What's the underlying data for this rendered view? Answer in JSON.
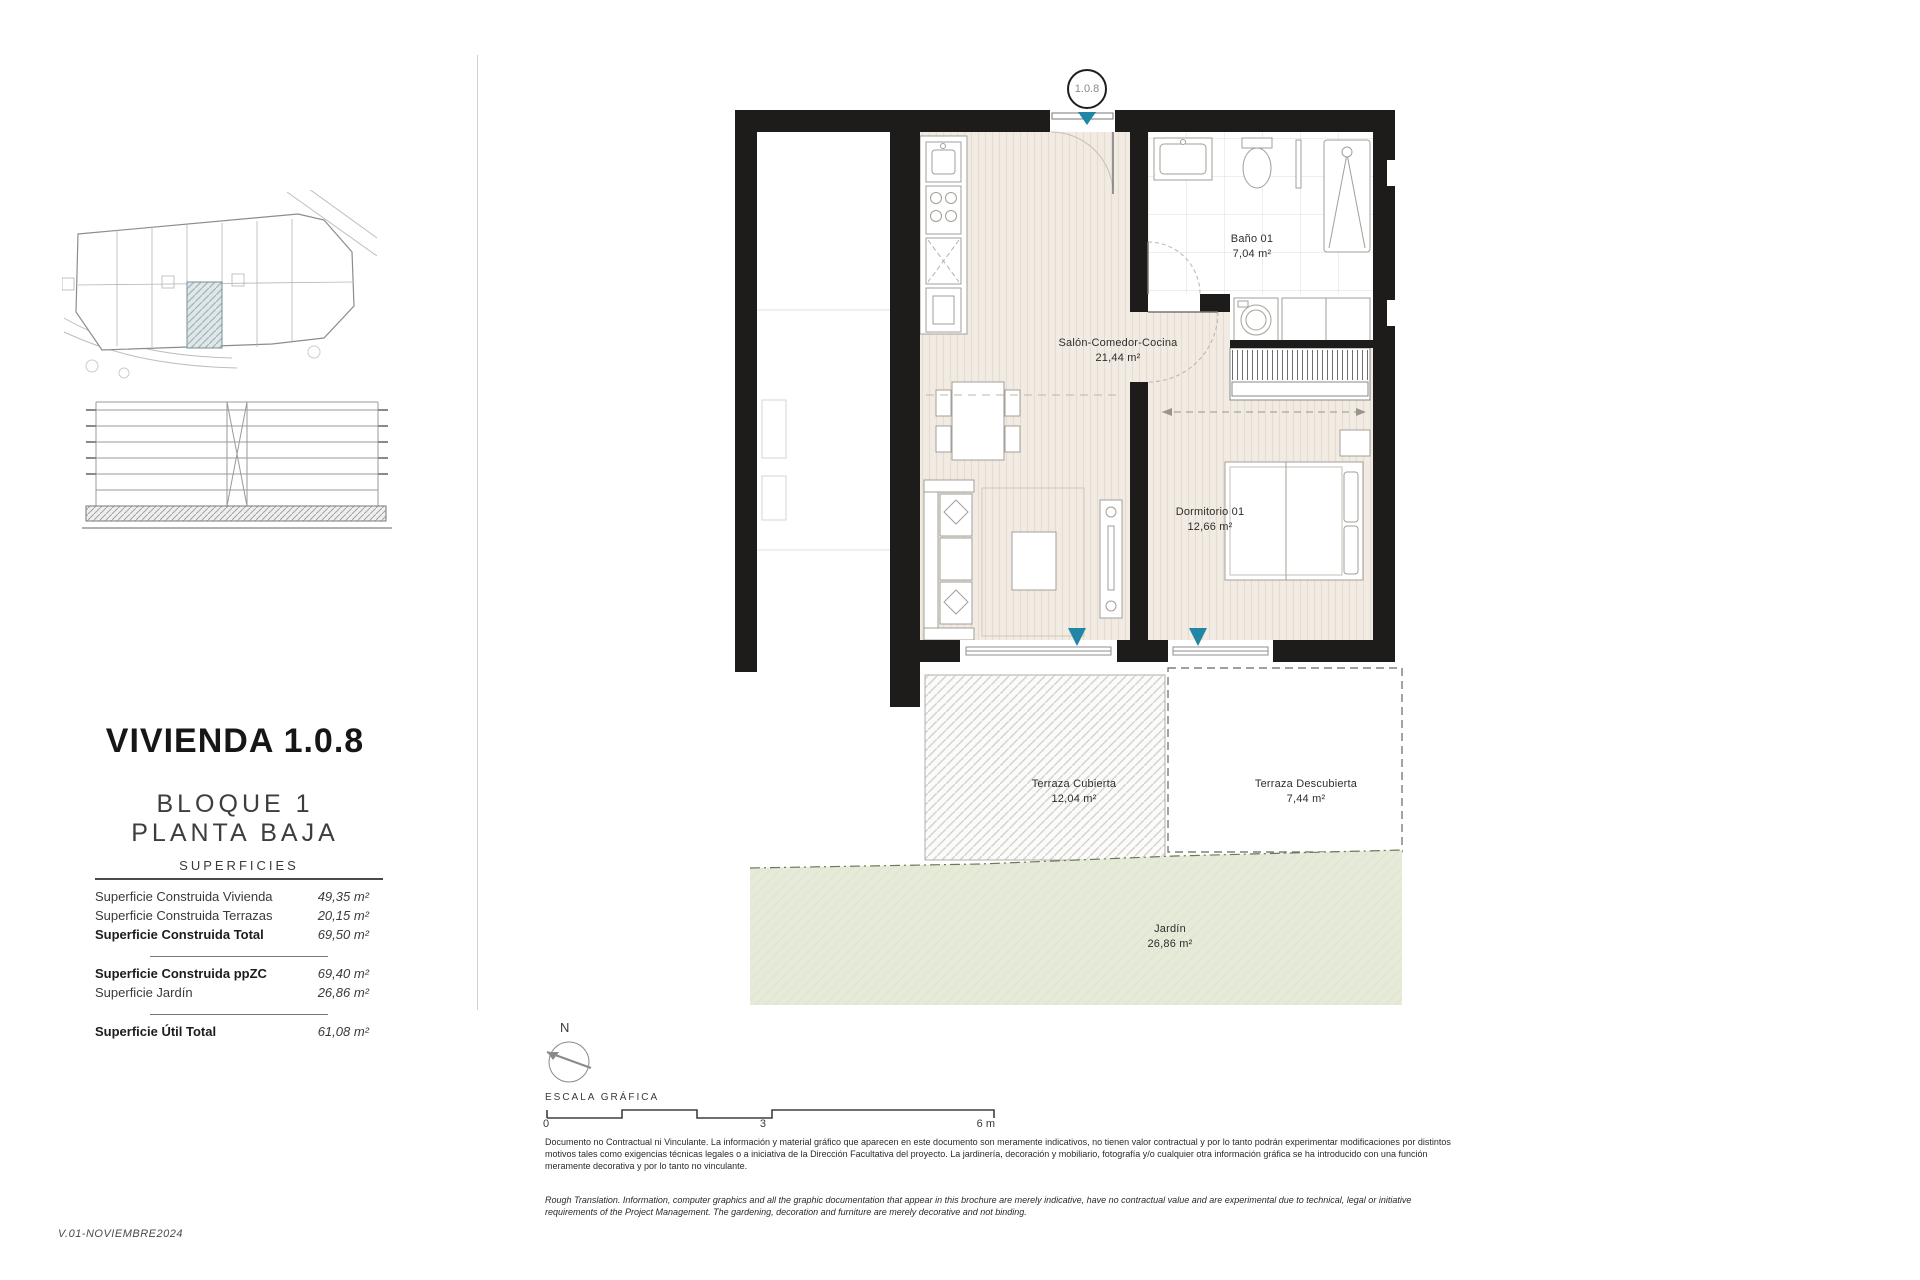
{
  "page": {
    "version": "V.01-NOVIEMBRE2024"
  },
  "title_block": {
    "title": "VIVIENDA 1.0.8",
    "block": "BLOQUE 1",
    "floor": "PLANTA BAJA"
  },
  "superficies": {
    "header": "SUPERFICIES",
    "rows": [
      {
        "label": "Superficie Construida Vivienda",
        "value": "49,35 m²"
      },
      {
        "label": "Superficie Construida Terrazas",
        "value": "20,15 m²"
      },
      {
        "label": "Superficie Construida Total",
        "value": "69,50 m²"
      },
      {
        "label": "Superficie Construida ppZC",
        "value": "69,40 m²"
      },
      {
        "label": "Superficie Jardín",
        "value": "26,86 m²"
      },
      {
        "label": "Superficie Útil Total",
        "value": "61,08 m²"
      }
    ]
  },
  "plan": {
    "unit_badge": "1.0.8",
    "rooms": {
      "salon": {
        "name": "Salón-Comedor-Cocina",
        "area": "21,44 m²"
      },
      "bano": {
        "name": "Baño 01",
        "area": "7,04 m²"
      },
      "dormitorio": {
        "name": "Dormitorio 01",
        "area": "12,66 m²"
      },
      "terraza_cubierta": {
        "name": "Terraza Cubierta",
        "area": "12,04 m²"
      },
      "terraza_descubierta": {
        "name": "Terraza Descubierta",
        "area": "7,44 m²"
      },
      "jardin": {
        "name": "Jardín",
        "area": "26,86 m²"
      }
    },
    "colors": {
      "accent": "#2186a5",
      "wall": "#1d1c1a",
      "floor": "#f1ebe3",
      "garden": "#e6ebd9"
    }
  },
  "scale_bar": {
    "north_label": "N",
    "caption": "ESCALA GRÁFICA",
    "ticks": [
      "0",
      "3",
      "6 m"
    ]
  },
  "disclaimer": {
    "spanish": "Documento no Contractual ni Vinculante. La información y material gráfico que aparecen en este documento son meramente indicativos, no tienen valor contractual y por lo tanto podrán experimentar modificaciones por distintos motivos tales como exigencias técnicas legales o a iniciativa de la Dirección Facultativa del proyecto. La jardinería, decoración y mobiliario, fotografía y/o cualquier otra información gráfica se ha introducido con una función meramente decorativa y por lo tanto no vinculante.",
    "english": "Rough Translation. Information, computer graphics and all the graphic documentation that appear in this brochure are merely indicative, have no contractual value and are experimental due to technical, legal or initiative requirements of the Project Management. The gardening, decoration and furniture are merely decorative and not binding."
  }
}
